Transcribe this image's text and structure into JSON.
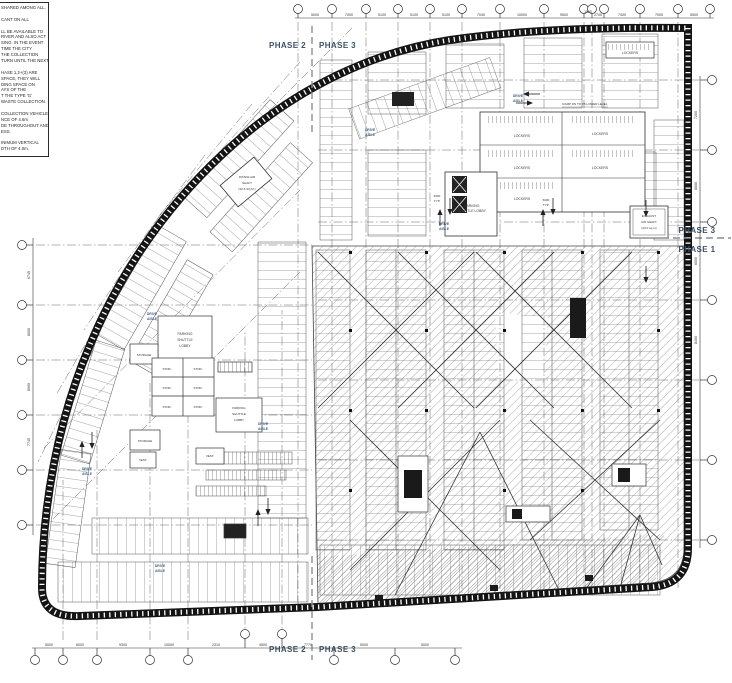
{
  "colors": {
    "wall": "#141414",
    "line": "#2b2b2b",
    "phase_text": "#3d5166",
    "aisle_text": "#44607e",
    "hatch": "#8a8a8a"
  },
  "notes": {
    "lines": [
      "SHARED AMONG ALL.",
      "",
      "CANT ON ALL",
      "",
      "LL BE AVAILABLE TO",
      "RIVER AND ALSO ACT",
      "SING.  IN THE EVENT",
      "TIME THE CITY",
      "THE COLLECTION",
      "TURN UNTIL THE NEXT",
      "",
      "HASE 1,2+(3) ARE",
      "SPACE, THEY WILL",
      "DING SPACE ON",
      "AYS OF THE",
      "T THE TYPE 'G'",
      "WASTE COLLECTION.",
      "",
      "COLLECTION VEHICLES",
      "NCE OF 4.6m",
      "DE THROUGHOUT AND",
      "ESS.",
      "",
      "INIMUM VERTICAL",
      "DTH OF 4.0m."
    ]
  },
  "phases": {
    "top_left": "PHASE 2",
    "top_right": "PHASE 3",
    "bottom_left": "PHASE 2",
    "bottom_right": "PHASE 3",
    "right_upper": "PHASE 3",
    "right_lower": "PHASE 1"
  },
  "labels": {
    "drive": "DRIVE",
    "aisle": "AISLE",
    "lockers": "LOCKERS",
    "storage": "STORAGE",
    "stor": "STOR.",
    "vest": "VEST.",
    "parking": "PARKING",
    "shuttle": "SHUTTLE",
    "lobby": "LOBBY",
    "shuttle_lobby": "SHUTTLE LOBBY",
    "exhaust_1": "EXHAUST",
    "exhaust_2": "AIR SHAFT",
    "exhaust_3": "(22.0 sq.m)",
    "intake_1": "INTAKE AIR",
    "intake_2": "SHAFT",
    "intake_3": "(30.6 SQ.M.)",
    "ramp_note": "RAMP DN TO P5 LOWER LEVEL",
    "typ_dim": "6000",
    "typ_suffix": "TYP."
  },
  "dims": {
    "top": [
      "5000",
      "7000",
      "5100",
      "5100",
      "5100",
      "7040",
      "10000",
      "9500",
      "1100",
      "2700",
      "7400",
      "7000",
      "5500"
    ],
    "right": [
      "7200",
      "8000",
      "6000",
      "8400"
    ],
    "left": [
      "6745",
      "8000",
      "8000",
      "7745"
    ],
    "bottom": [
      "5000",
      "6000",
      "9300",
      "10000",
      "2310",
      "4500",
      "7770",
      "5000",
      "5000"
    ]
  }
}
